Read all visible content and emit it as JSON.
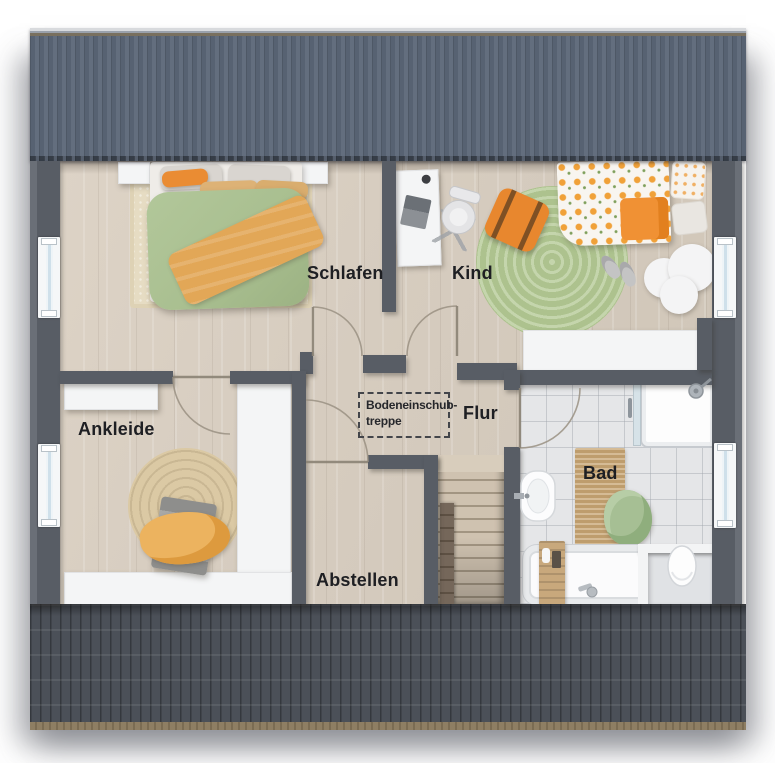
{
  "plan": {
    "type": "floorplan-top-view",
    "floor": "upper-floor"
  },
  "labels": {
    "schlafen": "Schlafen",
    "kind": "Kind",
    "ankleide": "Ankleide",
    "flur": "Flur",
    "abstellen": "Abstellen",
    "bad": "Bad",
    "attic_line1": "Bodeneinschub-",
    "attic_line2": "treppe"
  },
  "rooms": [
    {
      "name": "schlafen",
      "label": "Schlafen",
      "furniture": [
        "double-bed",
        "nightstands",
        "cream-rug"
      ]
    },
    {
      "name": "kind",
      "label": "Kind",
      "furniture": [
        "desk",
        "office-chair",
        "floor-cushion",
        "round-rug",
        "kids-bed",
        "cloud-rug",
        "slippers",
        "cabinet"
      ]
    },
    {
      "name": "ankleide",
      "label": "Ankleide",
      "furniture": [
        "wardrobes",
        "jute-rug",
        "bench",
        "blanket"
      ]
    },
    {
      "name": "flur",
      "label": "Flur",
      "furniture": [
        "attic-hatch"
      ]
    },
    {
      "name": "abstellen",
      "label": "Abstellen",
      "furniture": []
    },
    {
      "name": "bad",
      "label": "Bad",
      "furniture": [
        "shower",
        "bath-mat",
        "towel",
        "bathtub",
        "bath-caddy",
        "toilet",
        "sink"
      ]
    }
  ],
  "colors": {
    "roof_upper": "#5e6878",
    "roof_lower": "#4b5058",
    "gutter": "#8e7e63",
    "wall": "#585d65",
    "floor_wood": "#d6ccbf",
    "floor_tile": "#e5e6e8",
    "duvet_green": "#a9bf90",
    "accent_orange": "#e8872e",
    "rug_cream": "#e6dcc3",
    "rug_green": "#b6cb97",
    "rug_jute": "#dbc9a4",
    "bath_mat": "#c9a877",
    "furniture_white": "#f4f5f6",
    "label_text": "#1e1f23"
  }
}
